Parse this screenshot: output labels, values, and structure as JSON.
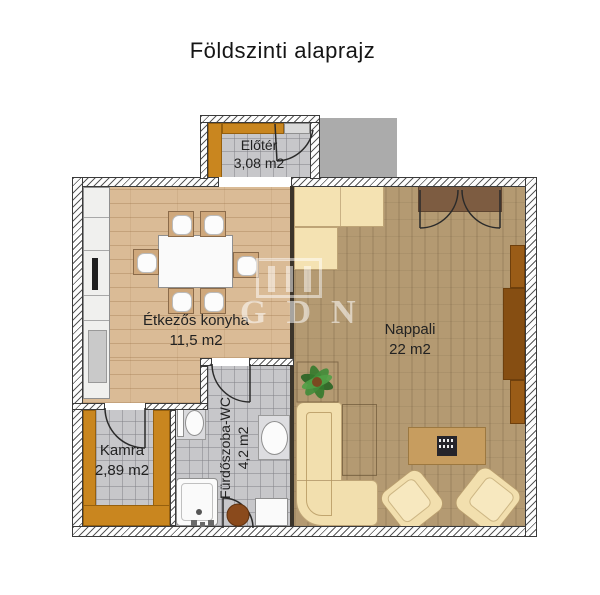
{
  "title": "Földszinti alaprajz",
  "rooms": {
    "eloter": {
      "name": "Előtér",
      "area": "3,08 m2"
    },
    "konyha": {
      "name": "Étkezős konyha",
      "area": "11,5 m2"
    },
    "nappali": {
      "name": "Nappali",
      "area": "22 m2"
    },
    "kamra": {
      "name": "Kamra",
      "area": "2,89 m2"
    },
    "furdoszoba": {
      "name": "Fürdőszoba-WC",
      "area": "4,2 m2"
    }
  },
  "watermark": {
    "text": "GDN"
  },
  "palette": {
    "wood_floor": "#dabb96",
    "carpet": "#b49a72",
    "tile": "#c7c7ca",
    "shelf_orange": "#c9861f",
    "cream_furniture": "#f4e2b2",
    "dark_wood": "#9a5c17",
    "door_mat_brown": "#7d5c41",
    "coffee_table": "#c79d5f",
    "steps_gray": "#ababab",
    "text": "#222222"
  }
}
